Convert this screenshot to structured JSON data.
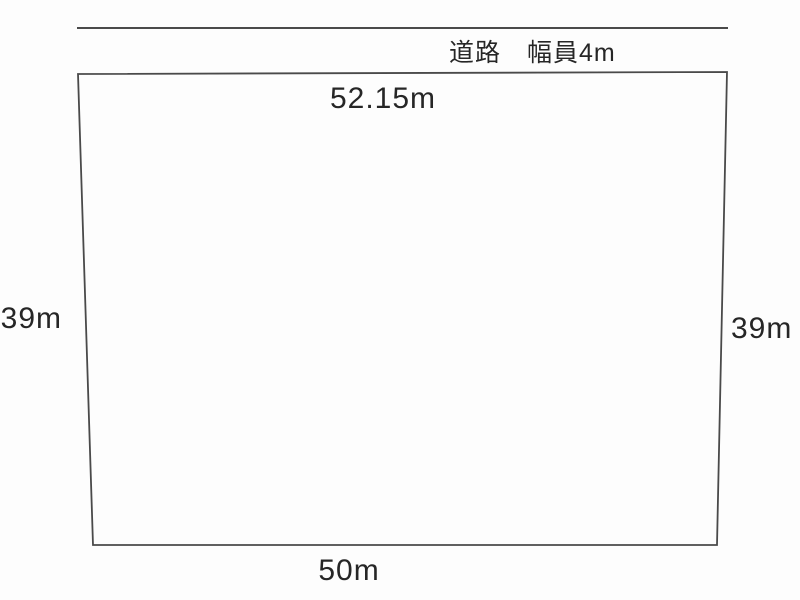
{
  "diagram": {
    "road": {
      "label": "道路　幅員4m"
    },
    "plot": {
      "dim_top": "52.15m",
      "dim_left": "39m",
      "dim_right": "39m",
      "dim_bottom": "50m"
    },
    "colors": {
      "line": "#4a4a4a",
      "text": "#262626",
      "background": "#fdfdfd"
    }
  }
}
